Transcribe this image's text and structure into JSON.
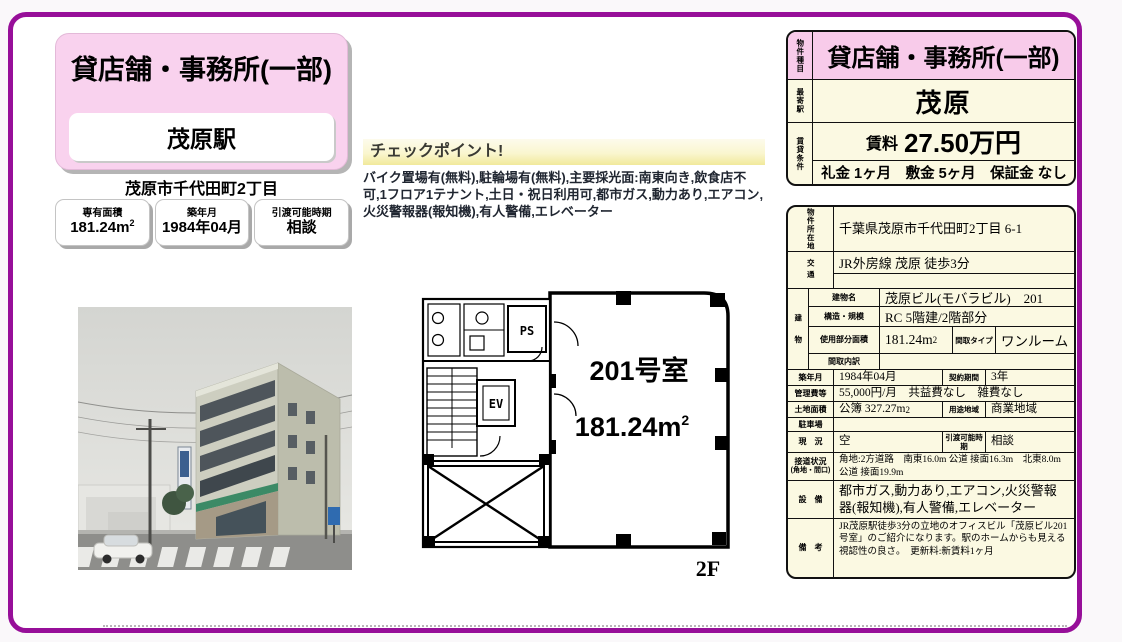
{
  "colors": {
    "accent_border": "#970F99",
    "pink_header": "#F8CBEA",
    "pink_card": "#F9D2EE",
    "cream": "#FBF9E2"
  },
  "title_card": {
    "property_type": "貸店舗・事務所(一部)",
    "station": "茂原駅",
    "address": "茂原市千代田町2丁目"
  },
  "summary_boxes": [
    {
      "label": "専有面積",
      "value": "181.24m",
      "sup": "2"
    },
    {
      "label": "築年月",
      "value": "1984年04月"
    },
    {
      "label": "引渡可能時期",
      "value": "相談"
    }
  ],
  "checkpoint": {
    "title": "チェックポイント!",
    "body": "バイク置場有(無料),駐輪場有(無料),主要採光面:南東向き,飲食店不可,1フロア1テナント,土日・祝日利用可,都市ガス,動力あり,エアコン,火災警報器(報知機),有人警備,エレベーター"
  },
  "floorplan": {
    "room": "201号室",
    "area": "181.24m",
    "area_sup": "2",
    "ps": "PS",
    "ev": "EV",
    "floor": "2F"
  },
  "head_table": {
    "type_label": "物件種目",
    "type": "貸店舗・事務所(一部)",
    "station_label": "最寄駅",
    "station": "茂原",
    "terms_label": "賃貸条件",
    "rent_label": "賃料",
    "rent": "27.50万円",
    "fees": "礼金 1ヶ月　敷金 5ヶ月　保証金 なし"
  },
  "details": {
    "location_label": "物件所在地",
    "location": "千葉県茂原市千代田町2丁目 6-1",
    "access_label": "交通",
    "access": "JR外房線 茂原 徒歩3分",
    "building_group_label": "建物",
    "building_name_label": "建物名",
    "building_name": "茂原ビル(モバラビル)　201",
    "structure_label": "構造・規模",
    "structure": "RC 5階建/2階部分",
    "used_area_label": "使用部分面積",
    "used_area": "181.24m",
    "used_area_sup": "2",
    "layout_type_label": "間取タイプ",
    "layout_type": "ワンルーム",
    "layout_detail_label": "間取内訳",
    "layout_detail": "",
    "built_label": "築年月",
    "built": "1984年04月",
    "contract_label": "契約期間",
    "contract": "3年",
    "management_label": "管理費等",
    "management": "55,000円/月　共益費なし　雑費なし",
    "land_label": "土地面積",
    "land": "公簿 327.27m",
    "land_sup": "2",
    "zoning_label": "用途地域",
    "zoning": "商業地域",
    "parking_label": "駐車場",
    "parking": "",
    "status_label": "現　況",
    "status": "空",
    "handover_label": "引渡可能時期",
    "handover": "相談",
    "road_label": "接道状況",
    "road_label_sub": "(角地・間口)",
    "road": "角地:2方道路　南東16.0m 公道 接面16.3m　北東8.0m 公道 接面19.9m",
    "equipment_label": "設　備",
    "equipment": "都市ガス,動力あり,エアコン,火災警報器(報知機),有人警備,エレベーター",
    "notes_label": "備　考",
    "notes": "JR茂原駅徒歩3分の立地のオフィスビル「茂原ビル201号室」のご紹介になります。駅のホームからも見える視認性の良さ。　更新料:新賃料1ヶ月"
  }
}
